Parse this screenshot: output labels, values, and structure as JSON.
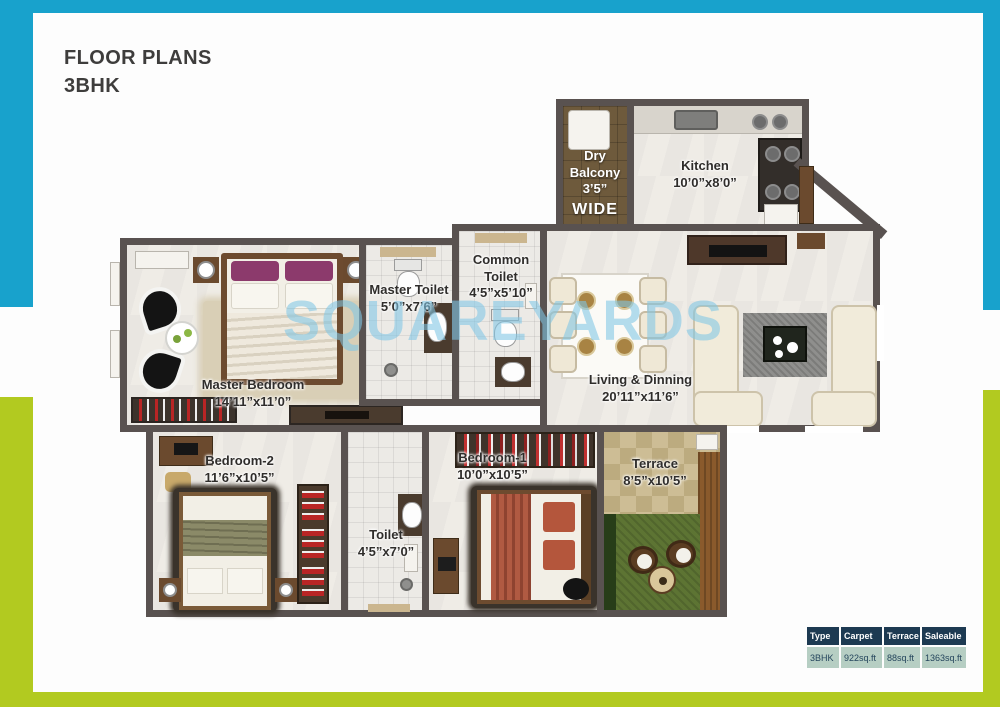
{
  "header": {
    "title_line1": "FLOOR PLANS",
    "title_line2": "3BHK"
  },
  "watermark": "SQUAREYARDS",
  "rooms": {
    "dry_balcony": {
      "name": "Dry Balcony",
      "size": "3’5”",
      "extra": "WIDE"
    },
    "kitchen": {
      "name": "Kitchen",
      "size": "10’0”x8’0”"
    },
    "master_toilet": {
      "name": "Master Toilet",
      "size": "5’0”x7’6”"
    },
    "common_toilet": {
      "name": "Common Toilet",
      "size": "4’5”x5’10”"
    },
    "master_bedroom": {
      "name": "Master Bedroom",
      "size": "14’11”x11’0”"
    },
    "living_dinning": {
      "name": "Living & Dinning",
      "size": "20’11”x11’6”"
    },
    "bedroom_2": {
      "name": "Bedroom-2",
      "size": "11’6”x10’5”"
    },
    "bedroom_1": {
      "name": "Bedroom-1",
      "size": "10’0”x10’5”"
    },
    "toilet": {
      "name": "Toilet",
      "size": "4’5”x7’0”"
    },
    "terrace": {
      "name": "Terrace",
      "size": "8’5”x10’5”"
    }
  },
  "area_table": {
    "headers": [
      "Type",
      "Carpet",
      "Terrace",
      "Saleable"
    ],
    "row": [
      "3BHK",
      "922sq.ft",
      "88sq.ft",
      "1363sq.ft"
    ]
  },
  "colors": {
    "accent_blue": "#18a2cc",
    "accent_green": "#b2ca20",
    "wall": "#595250",
    "table_header_bg": "#1d3a52",
    "table_row_bg": "#b6cec3"
  }
}
